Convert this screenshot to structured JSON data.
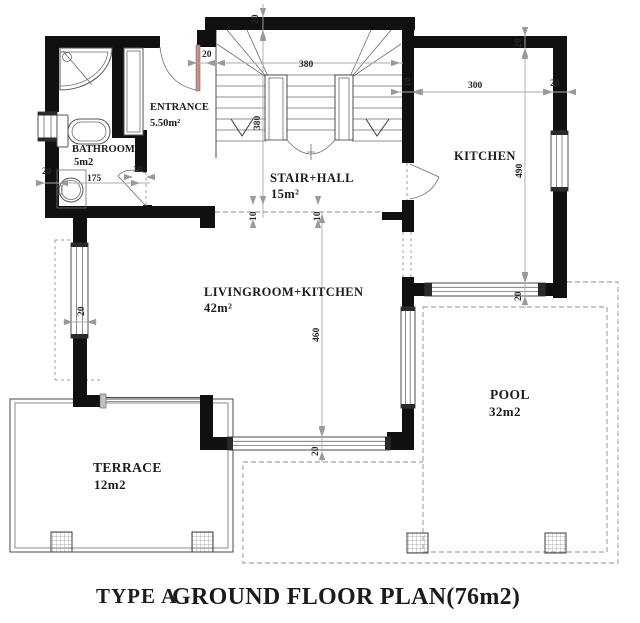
{
  "title": {
    "type": "TYPE A",
    "main": "GROUND FLOOR PLAN(76m2)"
  },
  "rooms": {
    "entrance": {
      "name": "ENTRANCE",
      "area": "5.50m²"
    },
    "bathroom": {
      "name": "BATHROOM",
      "area": "5m2"
    },
    "stair_hall": {
      "name": "STAIR+HALL",
      "area": "15m²"
    },
    "kitchen": {
      "name": "KITCHEN"
    },
    "livingroom": {
      "name": "LIVINGROOM+KITCHEN",
      "area": "42m²"
    },
    "terrace": {
      "name": "TERRACE",
      "area": "12m2"
    },
    "pool": {
      "name": "POOL",
      "area": "32m2"
    }
  },
  "dims": {
    "top_wall": "20",
    "stair_width": "380",
    "stair_depth": "380",
    "entrance_wall": "20",
    "hall_wall_a": "10",
    "hall_wall_b": "10",
    "kitchen_wall_left": "10",
    "kitchen_width": "300",
    "kitchen_wall_right": "20",
    "kitchen_top_wall": "20",
    "kitchen_depth": "490",
    "kitchen_window": "20",
    "living_depth": "460",
    "living_window": "20",
    "living_left_window": "20",
    "bath_wall": "20",
    "bath_width": "175",
    "bath_door": "10"
  },
  "colors": {
    "wall": "#101010",
    "drawing_line": "#4a4a4a",
    "dimension": "#9a9a9a",
    "door_accent": "#c2928a",
    "pillar_fill": "#ececec"
  }
}
